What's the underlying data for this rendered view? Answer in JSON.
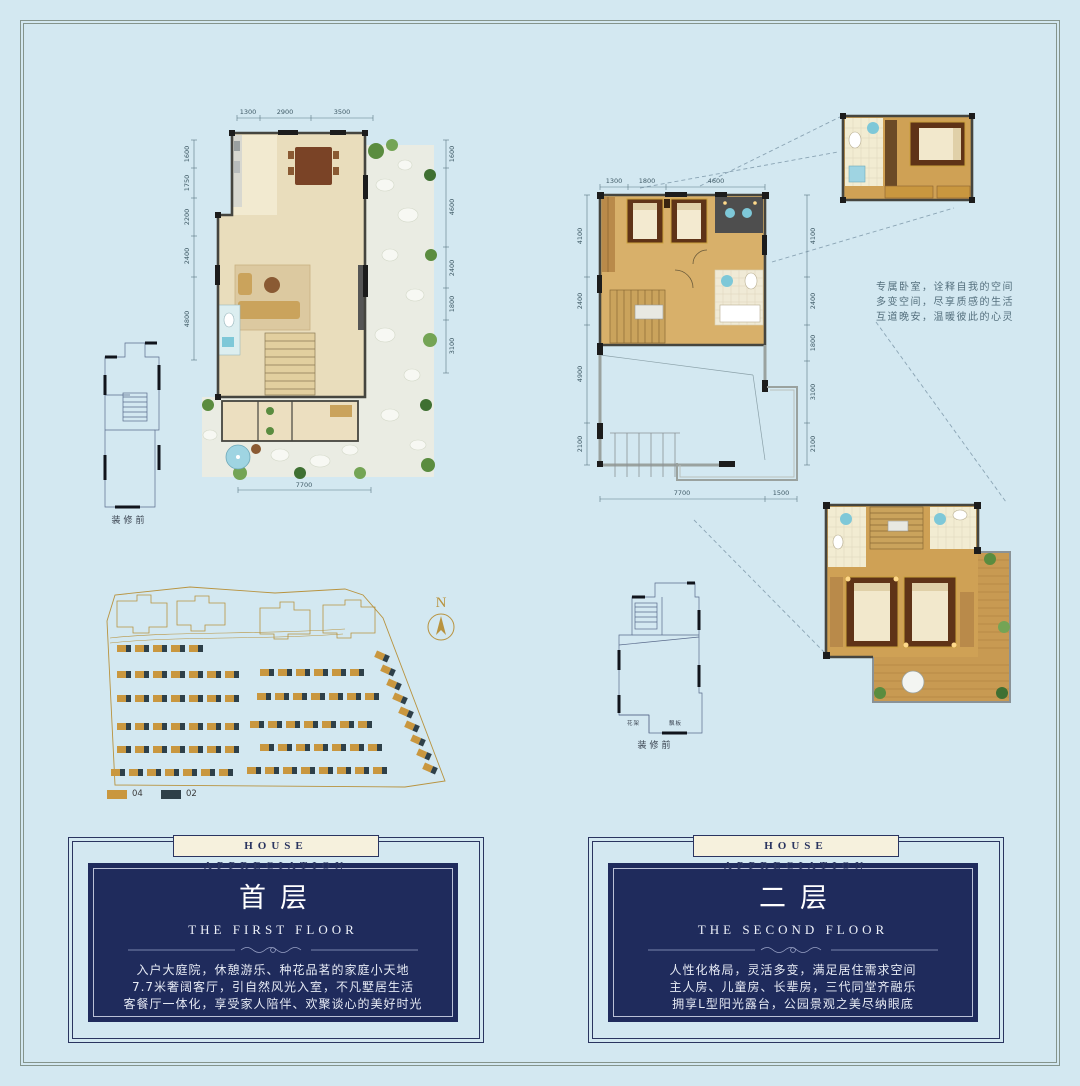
{
  "page": {
    "bg": "#d3e8f1"
  },
  "colors": {
    "gold": "#b8933f",
    "navy": "#1f2b5c",
    "cream": "#f6f1dd",
    "unit_tan": "#c9973f",
    "unit_dark": "#2e4049"
  },
  "plan1": {
    "dims": {
      "top": [
        "1300",
        "2900",
        "3500"
      ],
      "left": [
        "1600",
        "1750",
        "2200",
        "2400",
        "4800"
      ],
      "right": [
        "1600",
        "4600",
        "2400",
        "1800",
        "3100"
      ],
      "bottom": [
        "7700"
      ]
    },
    "sketch_caption": "装修前"
  },
  "plan2": {
    "dims": {
      "top": [
        "1300",
        "1800",
        "4600"
      ],
      "left": [
        "4100",
        "2400",
        "4900",
        "2100"
      ],
      "right": [
        "4100",
        "2400",
        "1800",
        "3100",
        "2100"
      ],
      "bottom": [
        "7700",
        "1500"
      ]
    },
    "sketch_caption": "装修前",
    "sketch_labels": [
      "花架",
      "飘板"
    ]
  },
  "annotation": {
    "lines": [
      "专属卧室，诠释自我的空间",
      "多变空间，尽享质感的生活",
      "互道晚安，温暖彼此的心灵"
    ]
  },
  "compass": {
    "label": "N"
  },
  "site_plan": {
    "legend": [
      {
        "label": "04",
        "color": "#c9973f"
      },
      {
        "label": "02",
        "color": "#2e4049"
      }
    ],
    "unit": {
      "w_main": 9,
      "w_dark": 5,
      "h": 7,
      "pitch": 18
    },
    "rows": [
      {
        "x": 22,
        "y": 62,
        "count": 5
      },
      {
        "x": 22,
        "y": 88,
        "count": 7
      },
      {
        "x": 165,
        "y": 86,
        "count": 6
      },
      {
        "x": 22,
        "y": 112,
        "count": 7
      },
      {
        "x": 162,
        "y": 110,
        "count": 7
      },
      {
        "x": 22,
        "y": 140,
        "count": 7
      },
      {
        "x": 155,
        "y": 138,
        "count": 7
      },
      {
        "x": 22,
        "y": 163,
        "count": 7
      },
      {
        "x": 165,
        "y": 161,
        "count": 7
      },
      {
        "x": 16,
        "y": 186,
        "count": 7
      },
      {
        "x": 152,
        "y": 184,
        "count": 8
      }
    ],
    "diagonal": {
      "x": 280,
      "y": 70,
      "count": 9,
      "dx": 6,
      "dy": 14,
      "angle": 24
    }
  },
  "cards": [
    {
      "banner": "HOUSE APPRECIATION",
      "title": "首层",
      "subtitle": "THE FIRST FLOOR",
      "lines": [
        "入户大庭院，休憩游乐、种花品茗的家庭小天地",
        "7.7米奢阔客厅，引自然风光入室，不凡墅居生活",
        "客餐厅一体化，享受家人陪伴、欢聚谈心的美好时光"
      ]
    },
    {
      "banner": "HOUSE APPRECIATION",
      "title": "二层",
      "subtitle": "THE SECOND FLOOR",
      "lines": [
        "人性化格局，灵活多变，满足居住需求空间",
        "主人房、儿童房、长辈房，三代同堂齐融乐",
        "拥享L型阳光露台，公园景观之美尽纳眼底"
      ]
    }
  ]
}
